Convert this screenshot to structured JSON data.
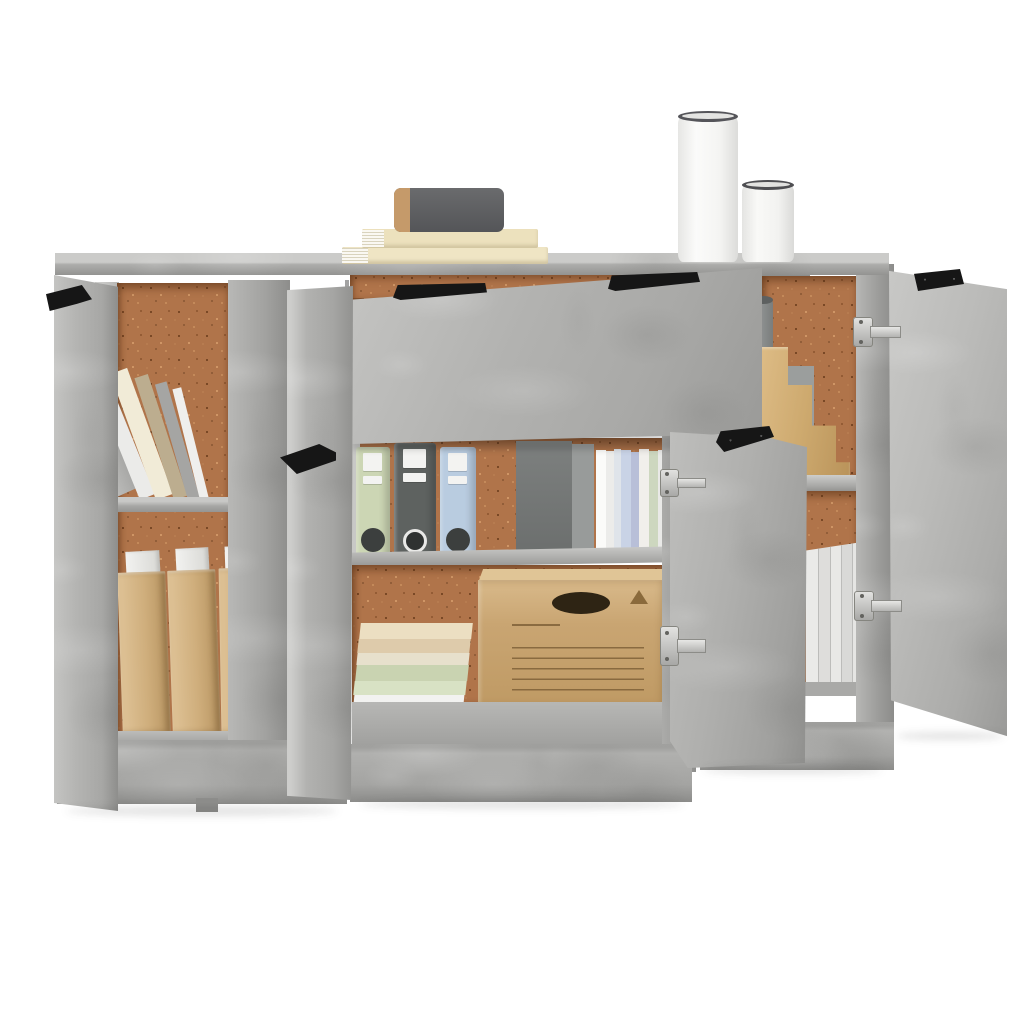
{
  "scene": {
    "type": "product photo",
    "background_color": "#ffffff",
    "subject": "Three-piece sideboard in concrete grey with open doors and a pulled-out drawer, styled with office storage props, on a plain white background"
  },
  "sideboard": {
    "finish": "concrete grey",
    "color_light": "#c6c6c4",
    "color_mid": "#adadab",
    "color_shadow": "#8f8f8d",
    "back_panel_color": "#b0744a",
    "handle_color": "#161616",
    "hinge_color": "#d2d2d0",
    "left_cabinet": {
      "door_state": "open, shown edge-on at far left with black top handle",
      "top_compartment": "six books leaning left against the inner wall over a cork back panel",
      "bottom_compartment": "three tan cardboard magazine files with white papers inside"
    },
    "middle_cabinet": {
      "drawer_state": "wide drawer front tilted open with two slim black handles",
      "left_door_state": "open toward viewer with black handle",
      "shelf_contents": "green, grey and blue ring binders, a dark archive box and a row of standing books",
      "bottom_compartment": "stack of pastel books beside a cardboard storage box with an oval hand hole, ruled label lines and a recycling triangle"
    },
    "right_cabinet": {
      "middle_door_state": "open toward viewer with black handle and two silver hinges",
      "outer_door_state": "wide open to the right with black corner bracket and two silver hinges",
      "top_compartment": "stepped cardboard desk organizer with a grey tube",
      "bottom_compartment": "white upright file cases on the lower shelf"
    }
  },
  "props_on_top": {
    "book_stack": [
      {
        "position": "bottom",
        "color": "#efe5c4",
        "page_edge_color": "#f7f5ee"
      },
      {
        "position": "middle",
        "color": "#ece1bd",
        "page_edge_color": "#f7f5ee"
      },
      {
        "position": "top",
        "color": "#5d5e60",
        "spine_color": "#c59a6a"
      }
    ],
    "canisters": [
      {
        "size": "tall",
        "body_color": "#f6f6f4",
        "rim_color": "#55555a"
      },
      {
        "size": "short",
        "body_color": "#f4f4f2",
        "rim_color": "#4e4e52"
      }
    ]
  },
  "prop_colors": {
    "binder_green": "#ccd6b4",
    "binder_grey": "#5e6260",
    "binder_blue": "#b9cce0",
    "archive_box_grey": "#75787a",
    "cardboard": "#c9a572",
    "magazine_file_tan": "#cfae7c",
    "pastel_stack": [
      "#ecdfc2",
      "#decbab",
      "#e7e0cc",
      "#c9d3b1",
      "#d8e2c4"
    ],
    "white_files": "#e8e8e6",
    "grey_tube": "#83918e"
  }
}
